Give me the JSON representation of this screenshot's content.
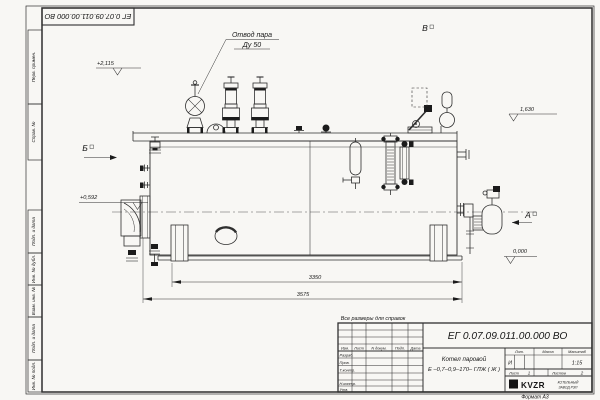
{
  "drawing_meta": {
    "doc_number": "ЕГ 0.07.09.011.00.000  ВО",
    "format_note": "Формат А3",
    "reference_note": "Все размеры для справок",
    "ink_color": "#2f2f2f",
    "paper_color": "#f8f7f4"
  },
  "frame_margin": {
    "cells_top": [
      "Перв. примен.",
      "Справ. №"
    ],
    "cells_bottom": [
      "Подп. и дата",
      "Инв. № дубл.",
      "Взам. инв. №",
      "Подп. и дата",
      "Инв. № подл."
    ]
  },
  "callouts": {
    "steam_line1": "Отвод пара",
    "steam_line2": "Ду 50",
    "view_top": "В",
    "view_left": "Б",
    "view_right": "А",
    "elev_deck": "+2,115",
    "elev_right": "1,630",
    "elev_burner": "+0,592",
    "elev_zero": "0,000",
    "dim_inner": "3350",
    "dim_overall": "3575"
  },
  "title_block": {
    "doc_number": "ЕГ 0.07.09.011.00.000  ВО",
    "name_line1": "Котел паровой",
    "name_line2": "Е –0,7–0,9–170– ГЛЖ ( Ж )",
    "col_izm": "Изм.",
    "col_list": "Лист",
    "col_docum": "N докум.",
    "col_podp": "Подп.",
    "col_data": "Дата",
    "row_razrab": "Разраб.",
    "row_prov": "Пров.",
    "row_tkontr": "Т.контр.",
    "row_nkontr": "Н.контр.",
    "row_utv": "Утв.",
    "lit_label": "Лит.",
    "lit_value": "И",
    "massa_label": "Масса",
    "scale_label": "Масштаб",
    "scale_value": "1:15",
    "sheet_label": "Лист",
    "sheet_value": "1",
    "sheets_label": "Листов",
    "sheets_value": "2",
    "logo": "KVZR",
    "company_line1": "КОТЕЛЬНЫЙ",
    "company_line2": "ЗАВОД РЭП"
  }
}
